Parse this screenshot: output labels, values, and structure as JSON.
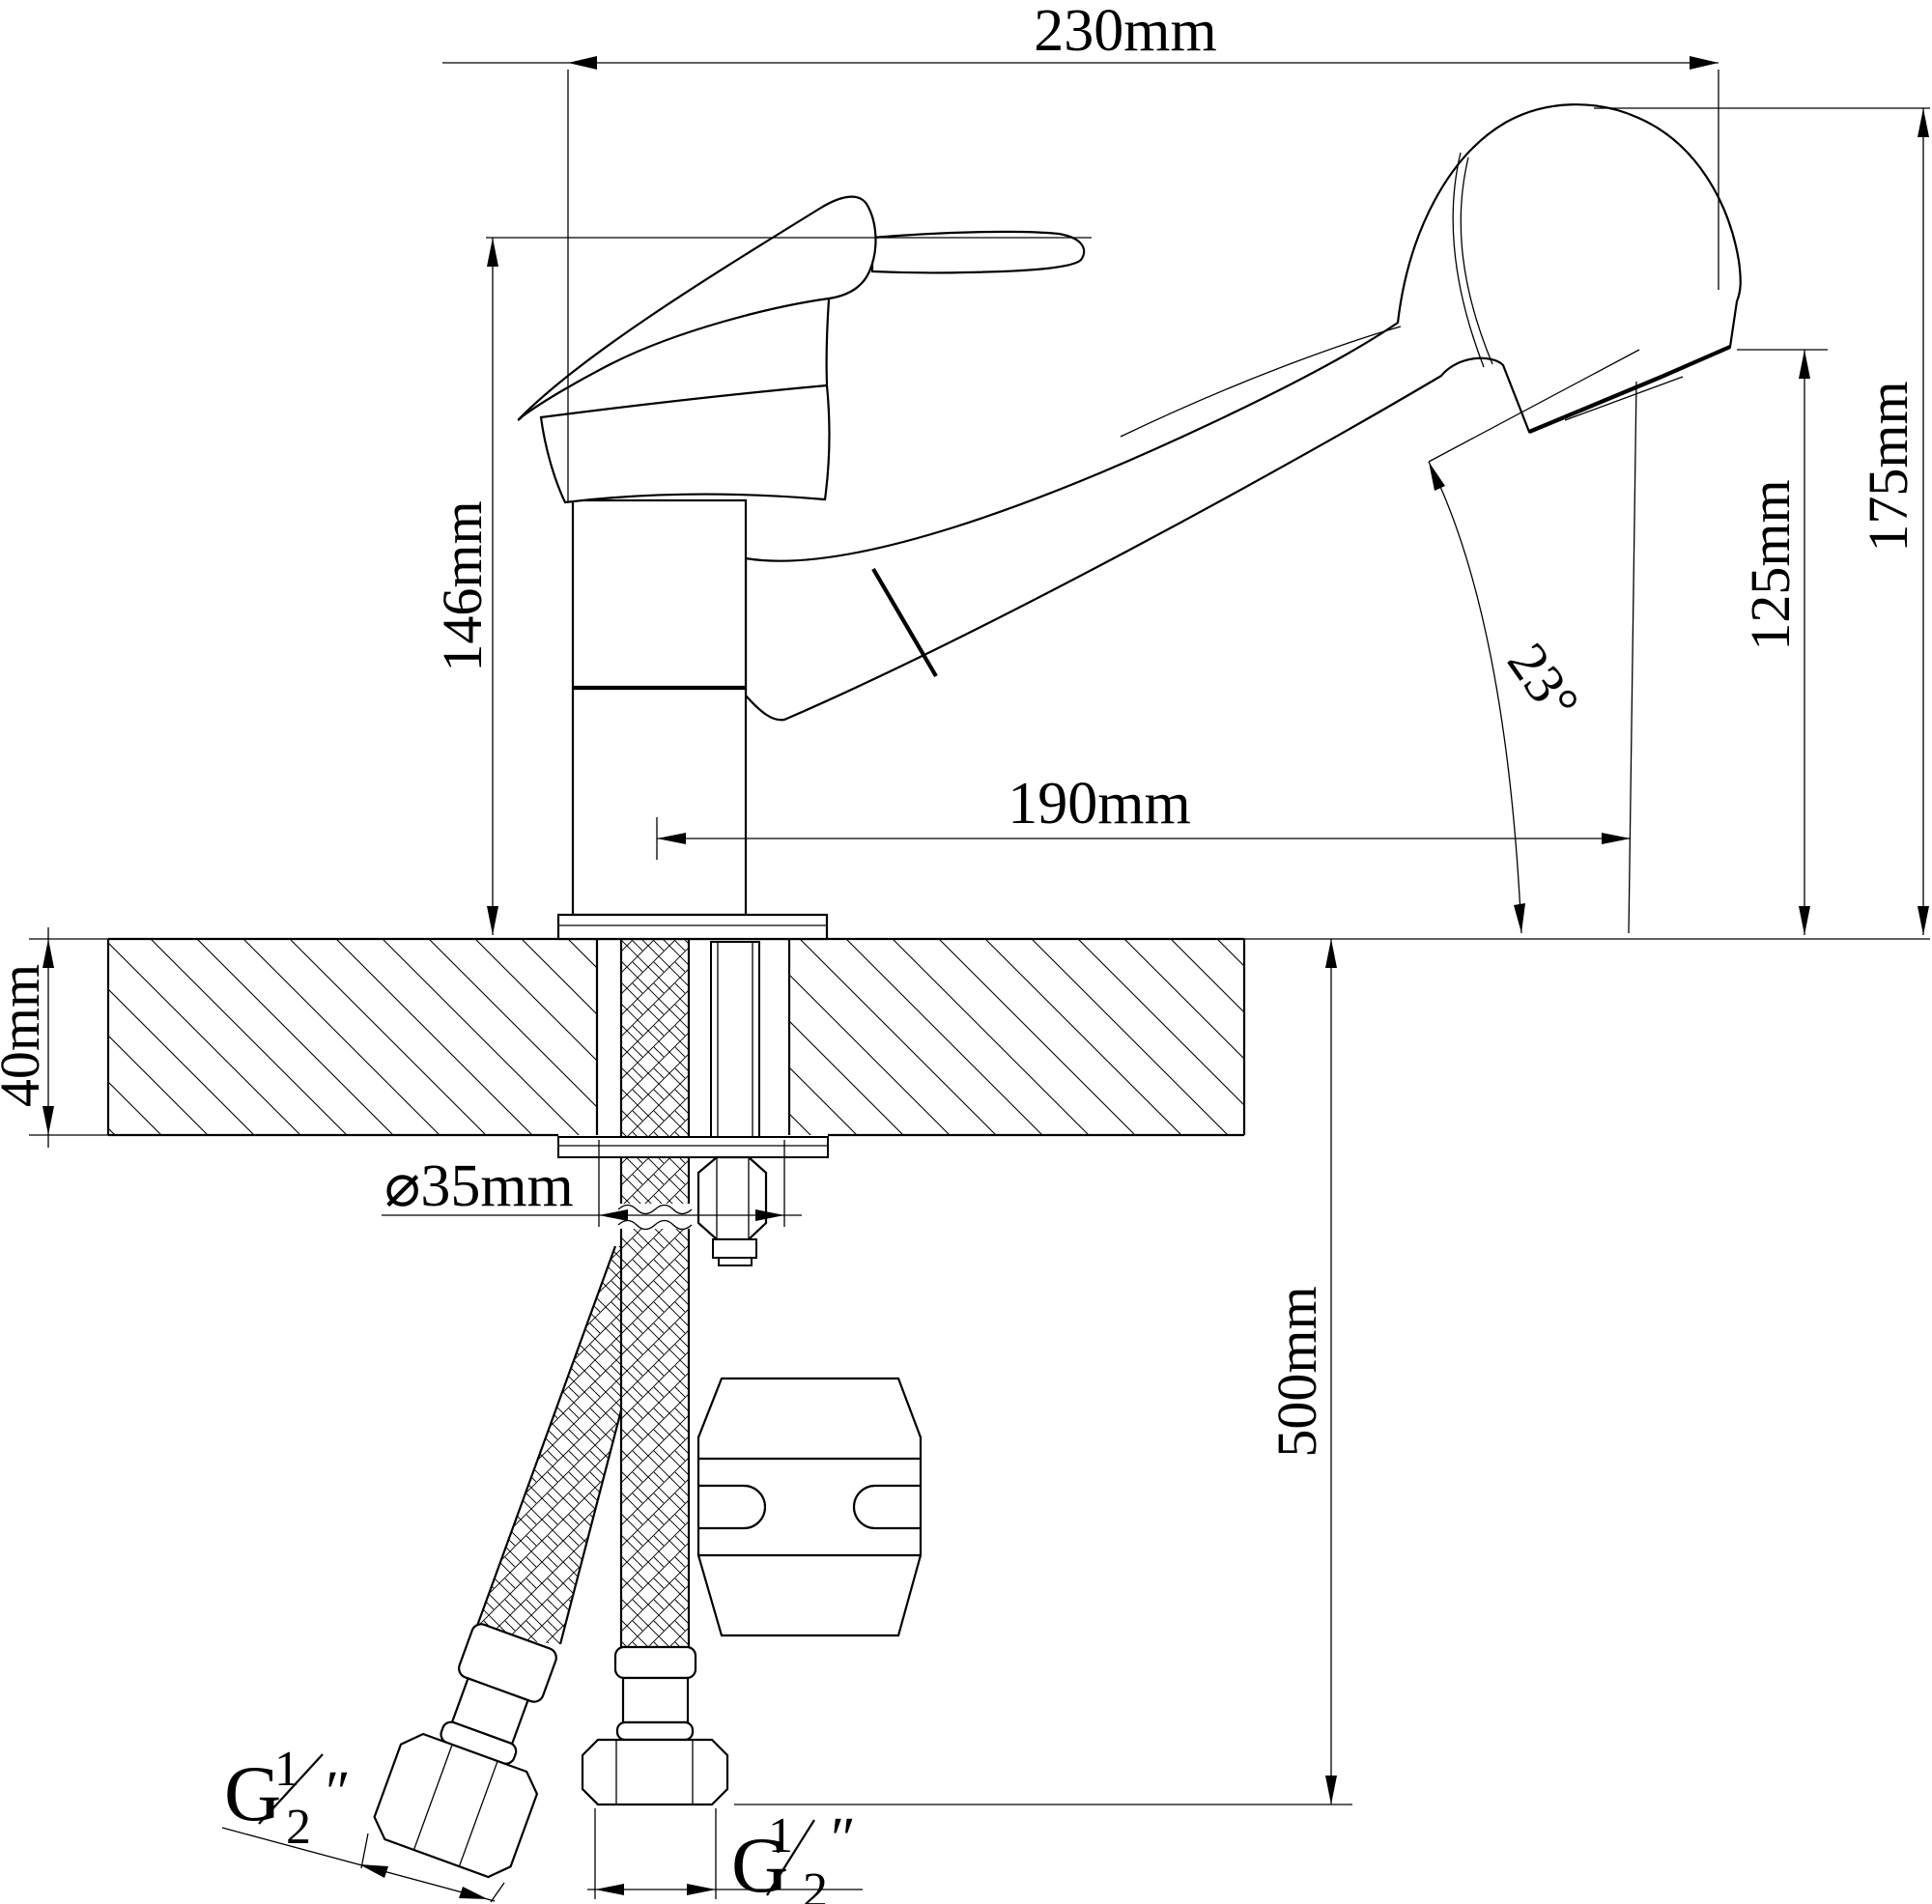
{
  "colors": {
    "line": "#000000",
    "background": "#ffffff"
  },
  "dimensions": {
    "overall_length": "230mm",
    "handle_height": "146mm",
    "total_height": "175mm",
    "spout_outlet_height": "125mm",
    "head_angle": "23°",
    "spout_reach": "190mm",
    "deck_thickness": "40mm",
    "hole_diameter": "⌀35mm",
    "hose_length": "500mm",
    "thread_left": {
      "prefix": "G",
      "numerator": "1",
      "denominator": "2",
      "inch_mark": "″"
    },
    "thread_bottom": {
      "prefix": "G",
      "numerator": "1",
      "denominator": "2",
      "inch_mark": "″"
    }
  }
}
